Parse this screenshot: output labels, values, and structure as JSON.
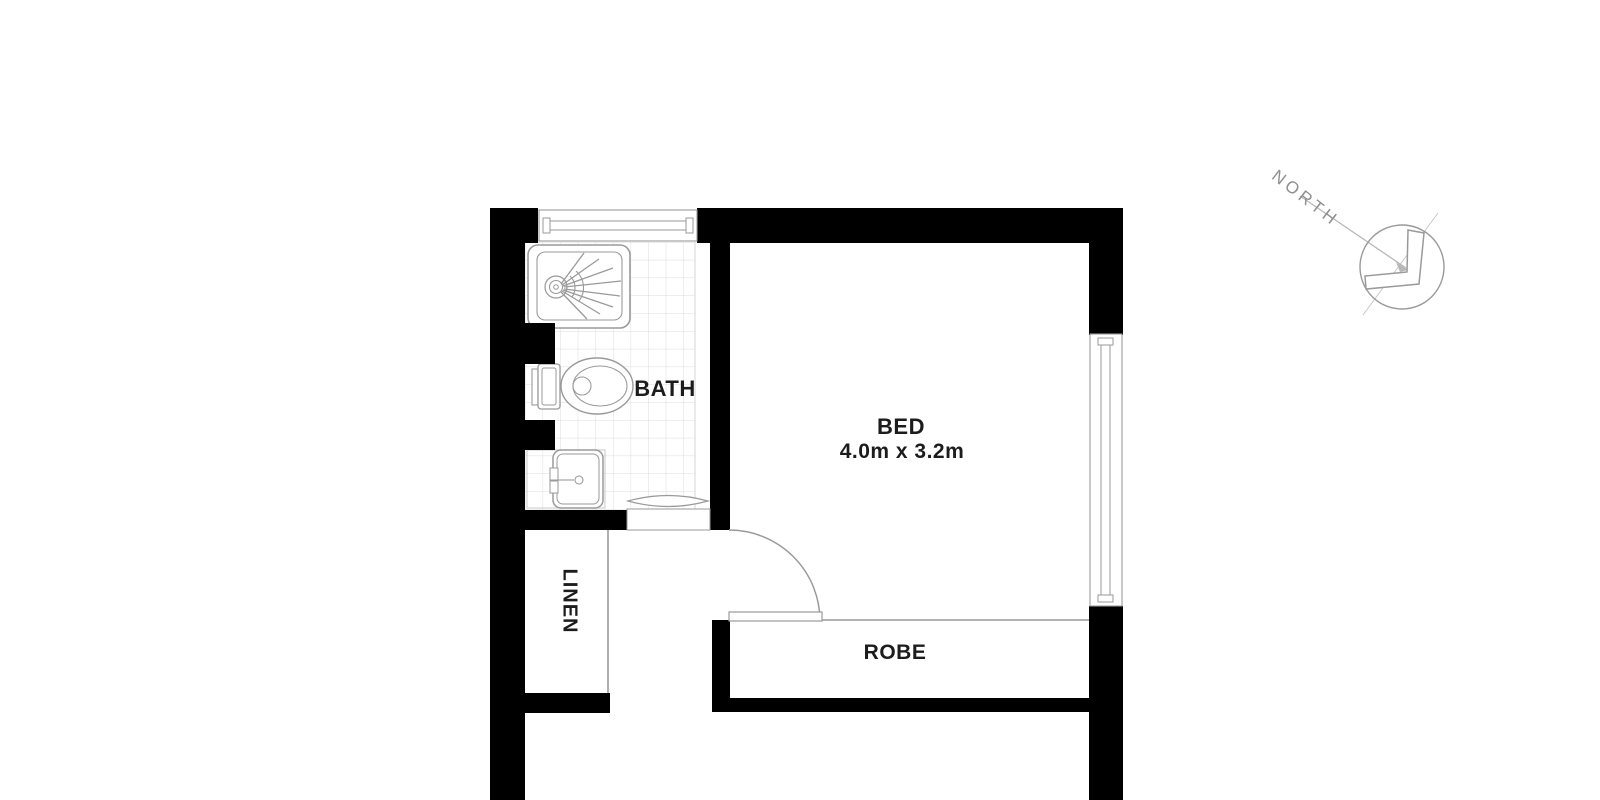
{
  "plan": {
    "title": "Floor plan — bedroom with ensuite bathroom",
    "rooms": [
      {
        "id": "bath",
        "label": "BATH"
      },
      {
        "id": "bed",
        "label": "BED",
        "dimensions": "4.0m x 3.2m"
      },
      {
        "id": "linen",
        "label": "LINEN"
      },
      {
        "id": "robe",
        "label": "ROBE"
      }
    ],
    "compass": {
      "label": "NORTH"
    },
    "fixtures": [
      "shower",
      "toilet",
      "vanity-sink",
      "sliding-door",
      "hinged-door",
      "window-top",
      "window-right"
    ],
    "colors": {
      "background": "#ffffff",
      "wall": "#000000",
      "fixture_line": "#9a9a9a",
      "faint_line": "#c8c8c8",
      "tile_line": "#dcdcdc",
      "label_text": "#1c1c1c",
      "compass_line": "#b8b8b8",
      "compass_text": "#8f8f8f"
    }
  }
}
